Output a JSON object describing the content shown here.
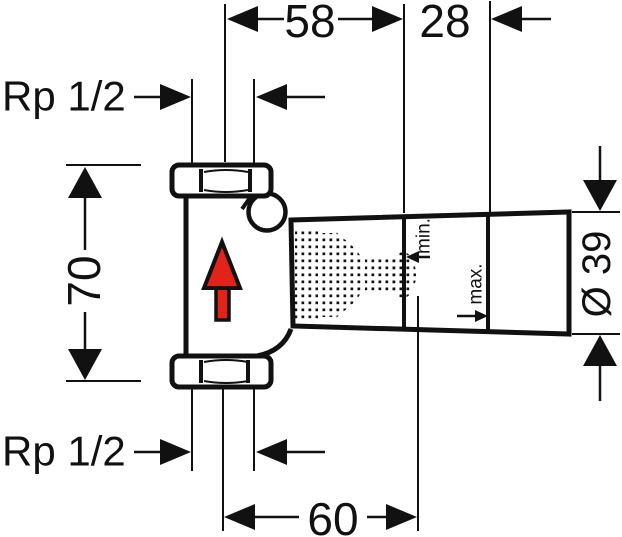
{
  "drawing": {
    "subject": "concealed-shutoff-valve-dimension-drawing",
    "background_color": "#ffffff",
    "line_color": "#111111",
    "dimensions": {
      "center_to_min": "58",
      "min_to_max": "28",
      "body_height": "70",
      "center_to_tip": "60",
      "housing_diameter": "Ø 39"
    },
    "thread_labels": {
      "top": "Rp 1/2",
      "bottom": "Rp 1/2"
    },
    "installation_depth": {
      "min": "min.",
      "max": "max."
    },
    "flow_arrow": {
      "direction": "up",
      "color": "#e2231a"
    }
  }
}
